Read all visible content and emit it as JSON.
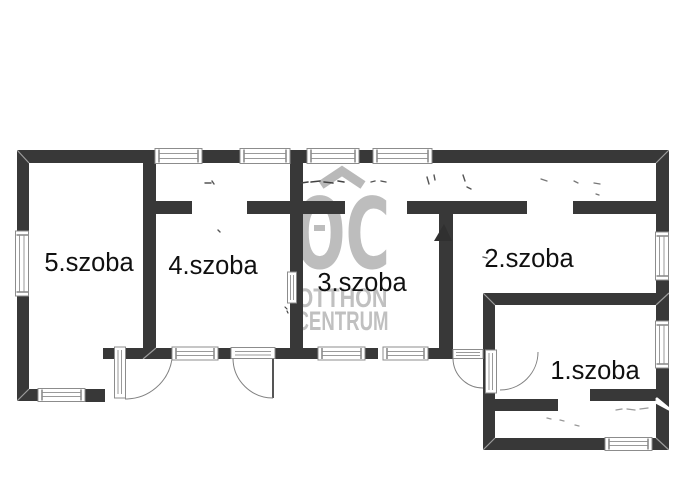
{
  "floorplan": {
    "type": "real-estate floor plan",
    "rooms": [
      {
        "label": "5.szoba"
      },
      {
        "label": "4.szoba"
      },
      {
        "label": "3.szoba"
      },
      {
        "label": "2.szoba"
      },
      {
        "label": "1.szoba"
      }
    ],
    "watermark": {
      "monogram": "OC",
      "line1": "OTTHON",
      "line2": "CENTRUM",
      "color": "#bdbdbd"
    },
    "colors": {
      "background": "#ffffff",
      "wall": "#383838",
      "window_frame": "#8c8c8c",
      "door_arc": "#808080",
      "label_text": "#101010"
    }
  }
}
